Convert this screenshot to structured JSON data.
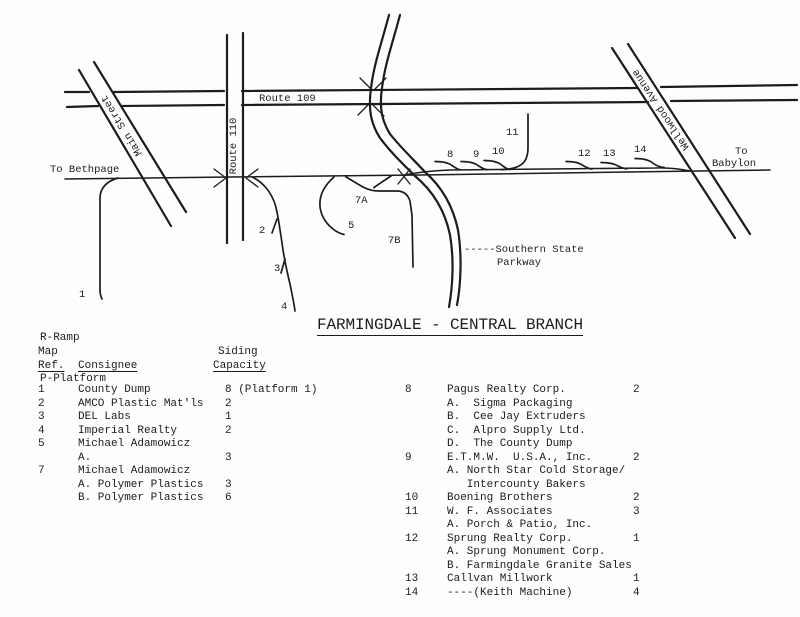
{
  "colors": {
    "ink": "#1c1c1c",
    "paper": "#fefefd"
  },
  "map": {
    "labels": {
      "route109": "Route 109",
      "route110": "Route 110",
      "main_street": "Main Street",
      "wellwood": "Wellwood Avenue",
      "to_bethpage": "To Bethpage",
      "to_babylon_line1": "To",
      "to_babylon_line2": "Babylon",
      "southern_state": "-----Southern State",
      "parkway": "Parkway"
    },
    "sidings": {
      "s1": "1",
      "s2": "2",
      "s3": "3",
      "s4": "4",
      "s5": "5",
      "s7a": "7A",
      "s7b": "7B",
      "s8": "8",
      "s9": "9",
      "s10": "10",
      "s11": "11",
      "s12": "12",
      "s13": "13",
      "s14": "14"
    }
  },
  "legend": {
    "line1": "R-Ramp",
    "line2": "P-Platform"
  },
  "title": "FARMINGDALE - CENTRAL BRANCH",
  "tables": {
    "left": {
      "headers": {
        "map": "Map",
        "ref": "Ref.",
        "consignee": "Consignee",
        "siding": "Siding",
        "capacity": "Capacity"
      },
      "rows": [
        {
          "ref": "1",
          "consignee": "County Dump",
          "capacity": "8 (Platform 1)"
        },
        {
          "ref": "2",
          "consignee": "AMCO Plastic Mat'ls",
          "capacity": "2"
        },
        {
          "ref": "3",
          "consignee": "DEL Labs",
          "capacity": "1"
        },
        {
          "ref": "4",
          "consignee": "Imperial Realty",
          "capacity": "2"
        },
        {
          "ref": "5",
          "consignee": "Michael Adamowicz",
          "capacity": ""
        },
        {
          "ref": "",
          "consignee": "A.",
          "capacity": "3"
        },
        {
          "ref": "7",
          "consignee": "Michael Adamowicz",
          "capacity": ""
        },
        {
          "ref": "",
          "consignee": "A. Polymer Plastics",
          "capacity": "3"
        },
        {
          "ref": "",
          "consignee": "B. Polymer Plastics",
          "capacity": "6"
        }
      ]
    },
    "right": {
      "rows": [
        {
          "ref": "8",
          "consignee": "Pagus Realty Corp.",
          "capacity": "2"
        },
        {
          "ref": "",
          "consignee": "A.  Sigma Packaging",
          "capacity": ""
        },
        {
          "ref": "",
          "consignee": "B.  Cee Jay Extruders",
          "capacity": ""
        },
        {
          "ref": "",
          "consignee": "C.  Alpro Supply Ltd.",
          "capacity": ""
        },
        {
          "ref": "",
          "consignee": "D.  The County Dump",
          "capacity": ""
        },
        {
          "ref": "9",
          "consignee": "E.T.M.W.  U.S.A., Inc.",
          "capacity": "2"
        },
        {
          "ref": "",
          "consignee": "A. North Star Cold Storage/",
          "capacity": ""
        },
        {
          "ref": "",
          "consignee": "   Intercounty Bakers",
          "capacity": ""
        },
        {
          "ref": "10",
          "consignee": "Boening Brothers",
          "capacity": "2"
        },
        {
          "ref": "11",
          "consignee": "W. F. Associates",
          "capacity": "3"
        },
        {
          "ref": "",
          "consignee": "A. Porch & Patio, Inc.",
          "capacity": ""
        },
        {
          "ref": "12",
          "consignee": "Sprung Realty Corp.",
          "capacity": "1"
        },
        {
          "ref": "",
          "consignee": "A. Sprung Monument Corp.",
          "capacity": ""
        },
        {
          "ref": "",
          "consignee": "B. Farmingdale Granite Sales",
          "capacity": ""
        },
        {
          "ref": "13",
          "consignee": "Callvan Millwork",
          "capacity": "1"
        },
        {
          "ref": "14",
          "consignee": "----(Keith Machine)",
          "capacity": "4"
        }
      ]
    }
  }
}
